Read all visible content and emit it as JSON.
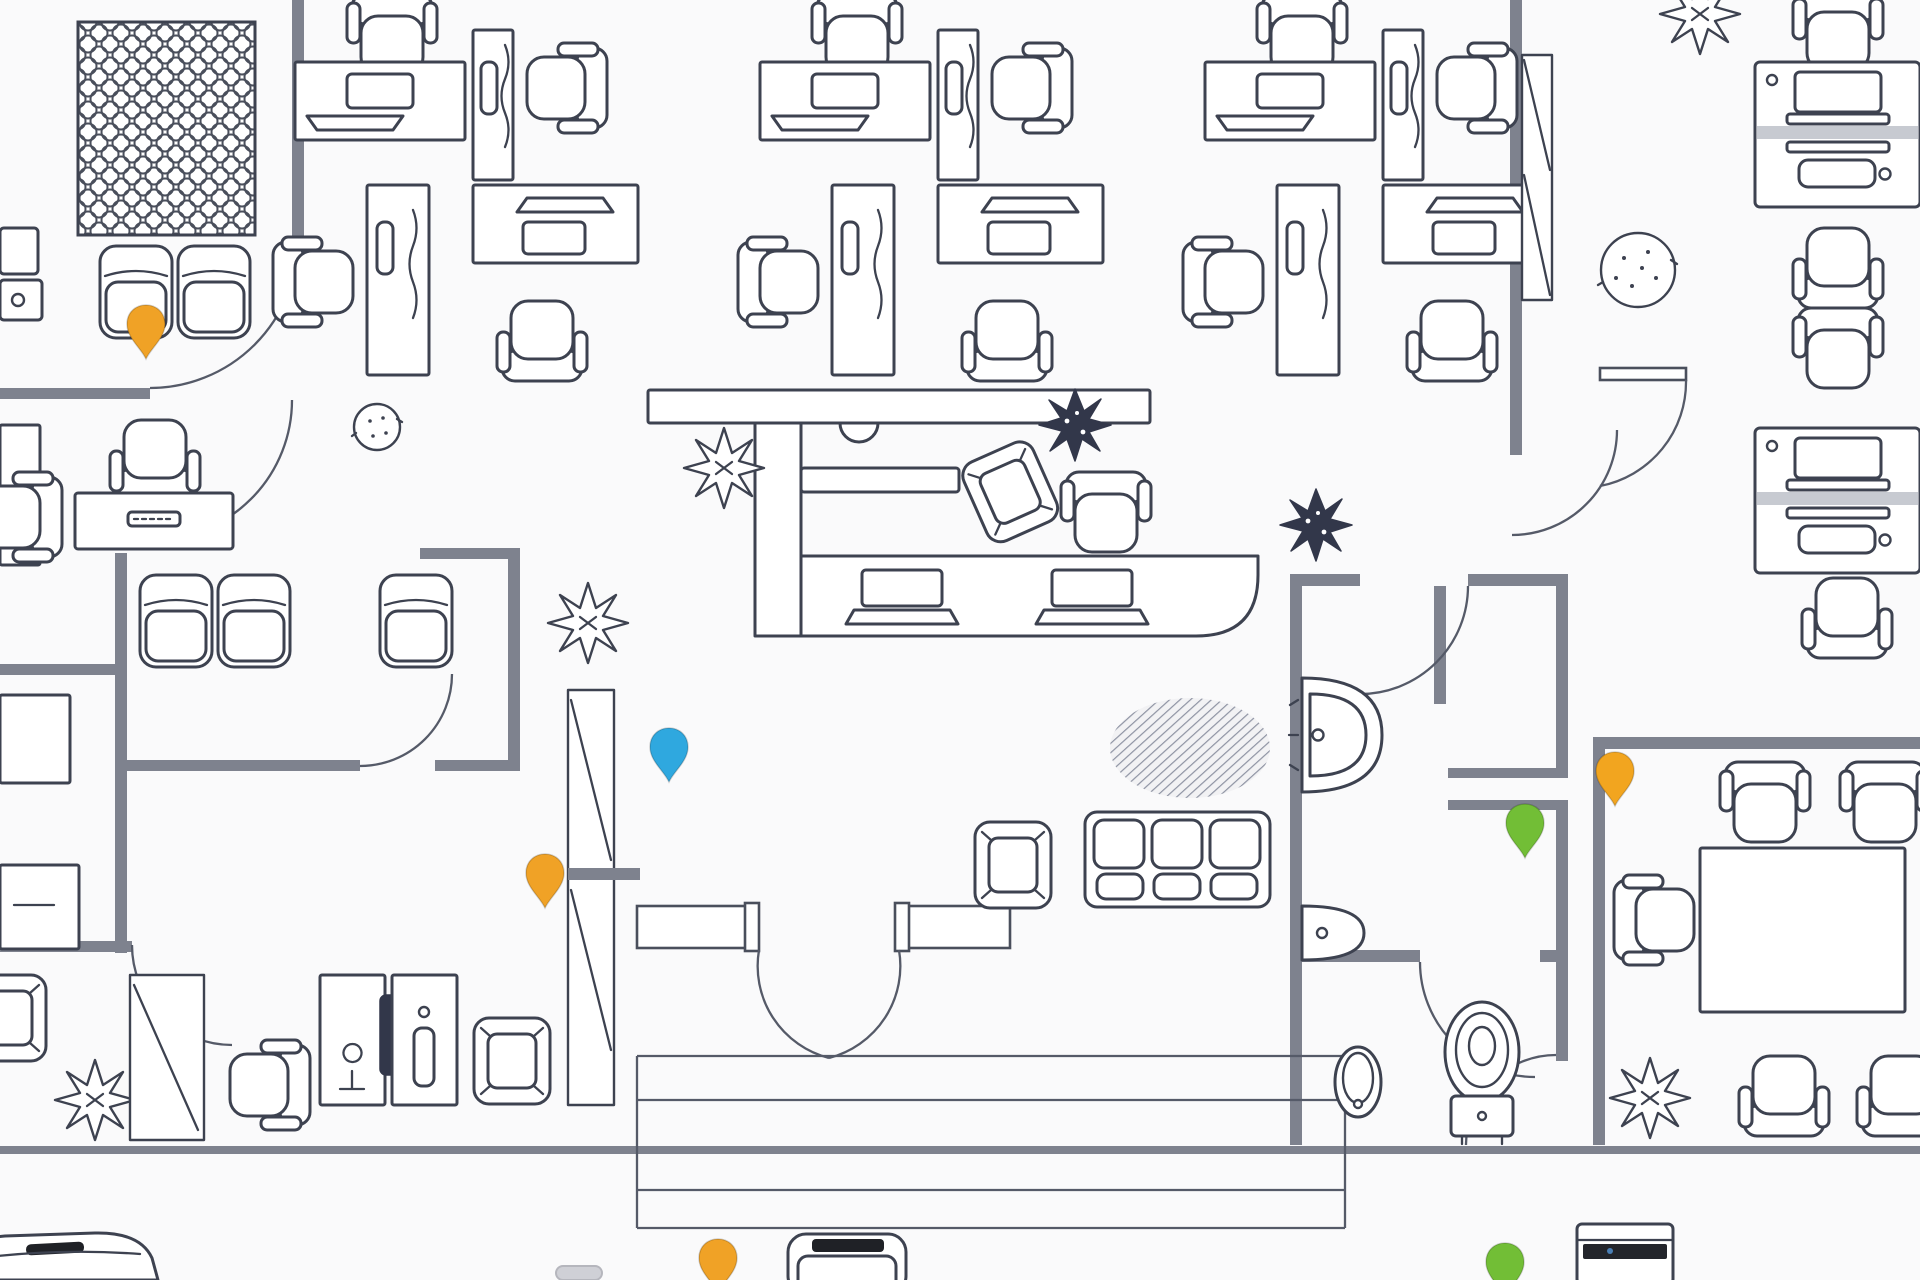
{
  "app": {
    "view": "office-floor-plan",
    "background": "#fafafb"
  },
  "palette": {
    "line": "#3d4250",
    "wall": "#7e828e",
    "pin_orange": "#F0A226",
    "pin_blue": "#2FA8DF",
    "pin_green": "#72BE36",
    "rug_texture": "#8e93a3",
    "legend_dark": "#1f2126"
  },
  "map": {
    "pins": [
      {
        "id": "map-pin-1",
        "color": "#F0A226",
        "color_name": "orange",
        "x": 146,
        "y": 332
      },
      {
        "id": "map-pin-2",
        "color": "#2FA8DF",
        "color_name": "blue",
        "x": 669,
        "y": 755
      },
      {
        "id": "map-pin-3",
        "color": "#F0A226",
        "color_name": "orange",
        "x": 545,
        "y": 881
      },
      {
        "id": "map-pin-4",
        "color": "#F2A51F",
        "color_name": "orange",
        "x": 1615,
        "y": 779
      },
      {
        "id": "map-pin-5",
        "color": "#72BE36",
        "color_name": "green",
        "x": 1525,
        "y": 831
      },
      {
        "id": "legend-pin-orange",
        "color": "#F0A226",
        "color_name": "orange",
        "x": 718,
        "y": 1266
      },
      {
        "id": "legend-pin-green",
        "color": "#72BE36",
        "color_name": "green",
        "x": 1505,
        "y": 1270
      }
    ],
    "furniture_icons": [
      "desk-cluster-icon",
      "office-chair-icon",
      "stool-chair-icon",
      "armchair-icon",
      "sofa-icon",
      "reception-counter-icon",
      "conference-table-icon",
      "lattice-table-icon",
      "plant-spiky-icon",
      "plant-dark-icon",
      "plant-round-icon",
      "stone-pot-icon",
      "sink-icon",
      "toilet-icon",
      "urinal-icon",
      "double-door-icon",
      "steps-icon",
      "shelf-cabinet-icon"
    ],
    "legend_icons_visible": [
      {
        "id": "legend-sofa-car-icon",
        "x": 0,
        "y": 1236
      },
      {
        "id": "legend-chair-icon",
        "x": 788,
        "y": 1234
      },
      {
        "id": "legend-vending-icon",
        "x": 1577,
        "y": 1224
      },
      {
        "id": "legend-partial-icon",
        "x": 556,
        "y": 1266
      }
    ]
  }
}
